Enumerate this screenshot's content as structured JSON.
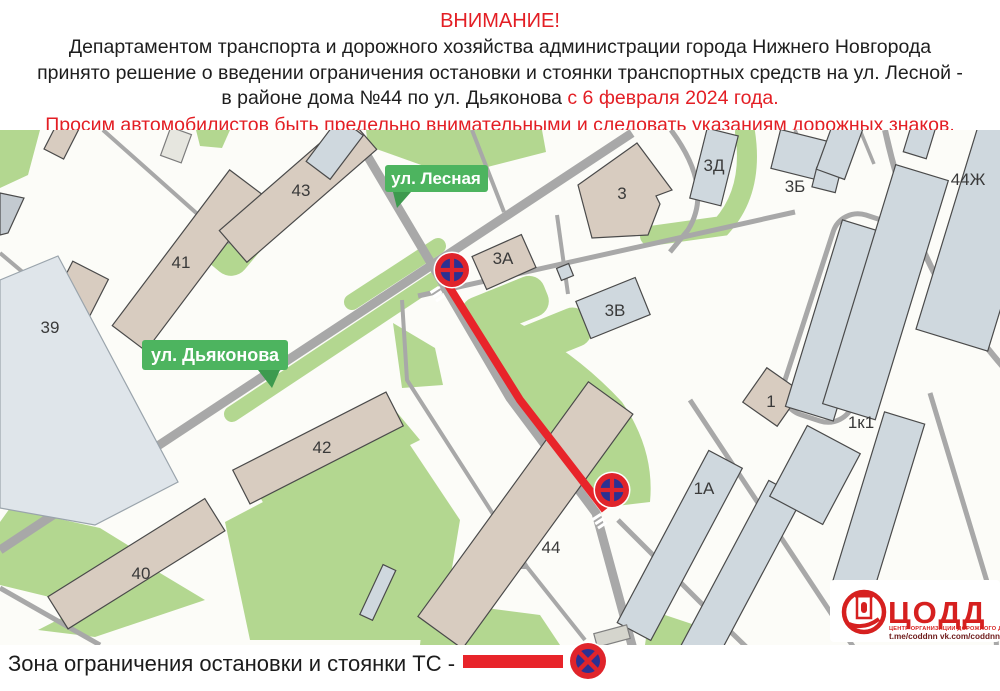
{
  "header": {
    "title": "ВНИМАНИЕ!",
    "body_line1": "Департаментом транспорта и дорожного хозяйства администрации города Нижнего Новгорода",
    "body_line2": "принято решение о введении ограничения остановки и стоянки транспортных средств на ул. Лесной -",
    "body_line3": "в районе дома №44 по ул. Дьяконова",
    "body_line3_highlight": "с 6 февраля 2024 года.",
    "warning": "Просим автомобилистов быть предельно внимательными и следовать указаниям дорожных знаков."
  },
  "map": {
    "street_labels": {
      "lesnaya": "ул. Лесная",
      "dyakonova": "ул. Дьяконова"
    },
    "building_labels": {
      "b39": "39",
      "b40": "40",
      "b41": "41",
      "b42": "42",
      "b43": "43",
      "b44": "44",
      "b3": "3",
      "b3a": "3А",
      "b3b": "3Б",
      "b3v": "3В",
      "b3d": "3Д",
      "b44zh": "44Ж",
      "b1": "1",
      "b1a": "1А",
      "b1k1": "1к1"
    },
    "icons": {
      "no_stopping_sign": "no-stopping-sign"
    }
  },
  "legend": {
    "label": "Зона ограничения остановки и стоянки ТС -"
  },
  "logo": {
    "title": "ЦОДД",
    "subtitle": "ЦЕНТР ОРГАНИЗАЦИИ ДОРОЖНОГО ДВИЖЕНИЯ",
    "links": "t.me/coddnn vk.com/coddnn52"
  },
  "colors": {
    "accent_red": "#e31e24",
    "restriction_red": "#e8242a",
    "map_green": "#b3d790",
    "road_gray": "#a8a8a8",
    "building_tan": "#d8ccc0",
    "building_gray": "#cfd8de",
    "badge_green": "#4db45f",
    "sign_blue": "#2c3192"
  }
}
